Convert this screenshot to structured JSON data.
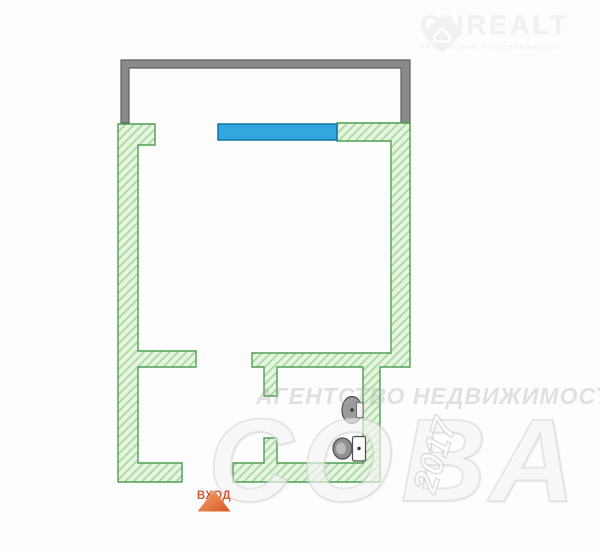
{
  "brand": {
    "name": "ONREALT",
    "tagline": "объявления о недвижимости",
    "icon": "house-in-diamond-icon"
  },
  "watermarks": {
    "agency": "АГЕНТСТВО НЕДВИЖИМОСТИ",
    "big": "СОВА",
    "year": "2017"
  },
  "floorplan": {
    "entrance_label": "ВХОД",
    "features": [
      "balcony",
      "window",
      "entrance-gap",
      "bathroom"
    ],
    "fixtures": [
      "sink",
      "toilet"
    ],
    "colors": {
      "wall_fill": "#e7f5e0",
      "wall_hatch": "#a6d8a2",
      "wall_border": "#4f9f52",
      "balcony_gray": "#8a8a8a",
      "balcony_border": "#5f5f5f",
      "window_blue": "#33a6df",
      "window_border": "#1273ad",
      "fixture_gray": "#9b9b9b",
      "entrance_orange_light": "#f5a878",
      "entrance_orange_dark": "#d8571f",
      "entrance_text": "#ce5c36"
    }
  }
}
